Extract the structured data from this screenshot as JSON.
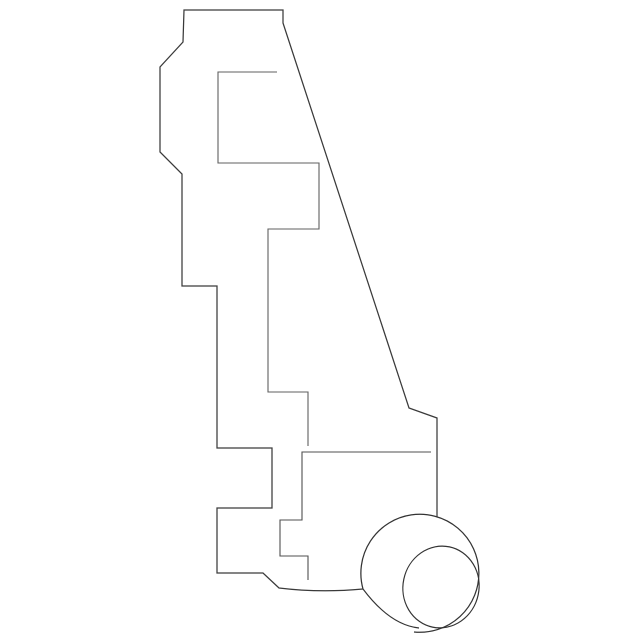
{
  "canvas": {
    "width": 640,
    "height": 642,
    "background": "#ffffff"
  },
  "drawing": {
    "description": "line-art technical illustration of an automotive lamp socket bracket, side profile view with bulb socket at lower right",
    "colors": {
      "outline": "#3a3a3a",
      "socket": "#333333",
      "inner_contour": "#5f5f5f"
    },
    "paths": [
      {
        "name": "bracket-outline",
        "stroke": "#3a3a3a",
        "width": 1.25,
        "d": "M437,517 L437,418 L409,408 L283,23 L283,10 L184,10 L183,42 L160,67 L160,152 L182,174 L182,286 L217,286 L217,448 L272,448 L272,508 L217,508 L217,573 L263,573 L279,588 Q320,593 363,589"
      },
      {
        "name": "socket-body-arc",
        "stroke": "#333333",
        "width": 1.25,
        "d": "M363,589 A59,59 0 1 1 414,632"
      },
      {
        "name": "socket-cone-flank",
        "stroke": "#333333",
        "width": 1.15,
        "d": "M363,589 Q390,625 419,628"
      },
      {
        "name": "inner-contour-upper",
        "stroke": "#5f5f5f",
        "width": 1.1,
        "d": "M277,72 L218,72 L218,163 L319,163 L319,229 L268,229 L268,392 L308,392 L308,446"
      },
      {
        "name": "inner-contour-lower",
        "stroke": "#4f4f4f",
        "width": 1.1,
        "d": "M431,452 L302,452 L302,520 L280,520 L280,556 L308,556 L308,580"
      }
    ],
    "ellipses": [
      {
        "name": "socket-front-rim",
        "stroke": "#333333",
        "width": 1.2,
        "cx": 441,
        "cy": 587,
        "rx": 38,
        "ry": 41,
        "rotate": 12
      }
    ]
  }
}
